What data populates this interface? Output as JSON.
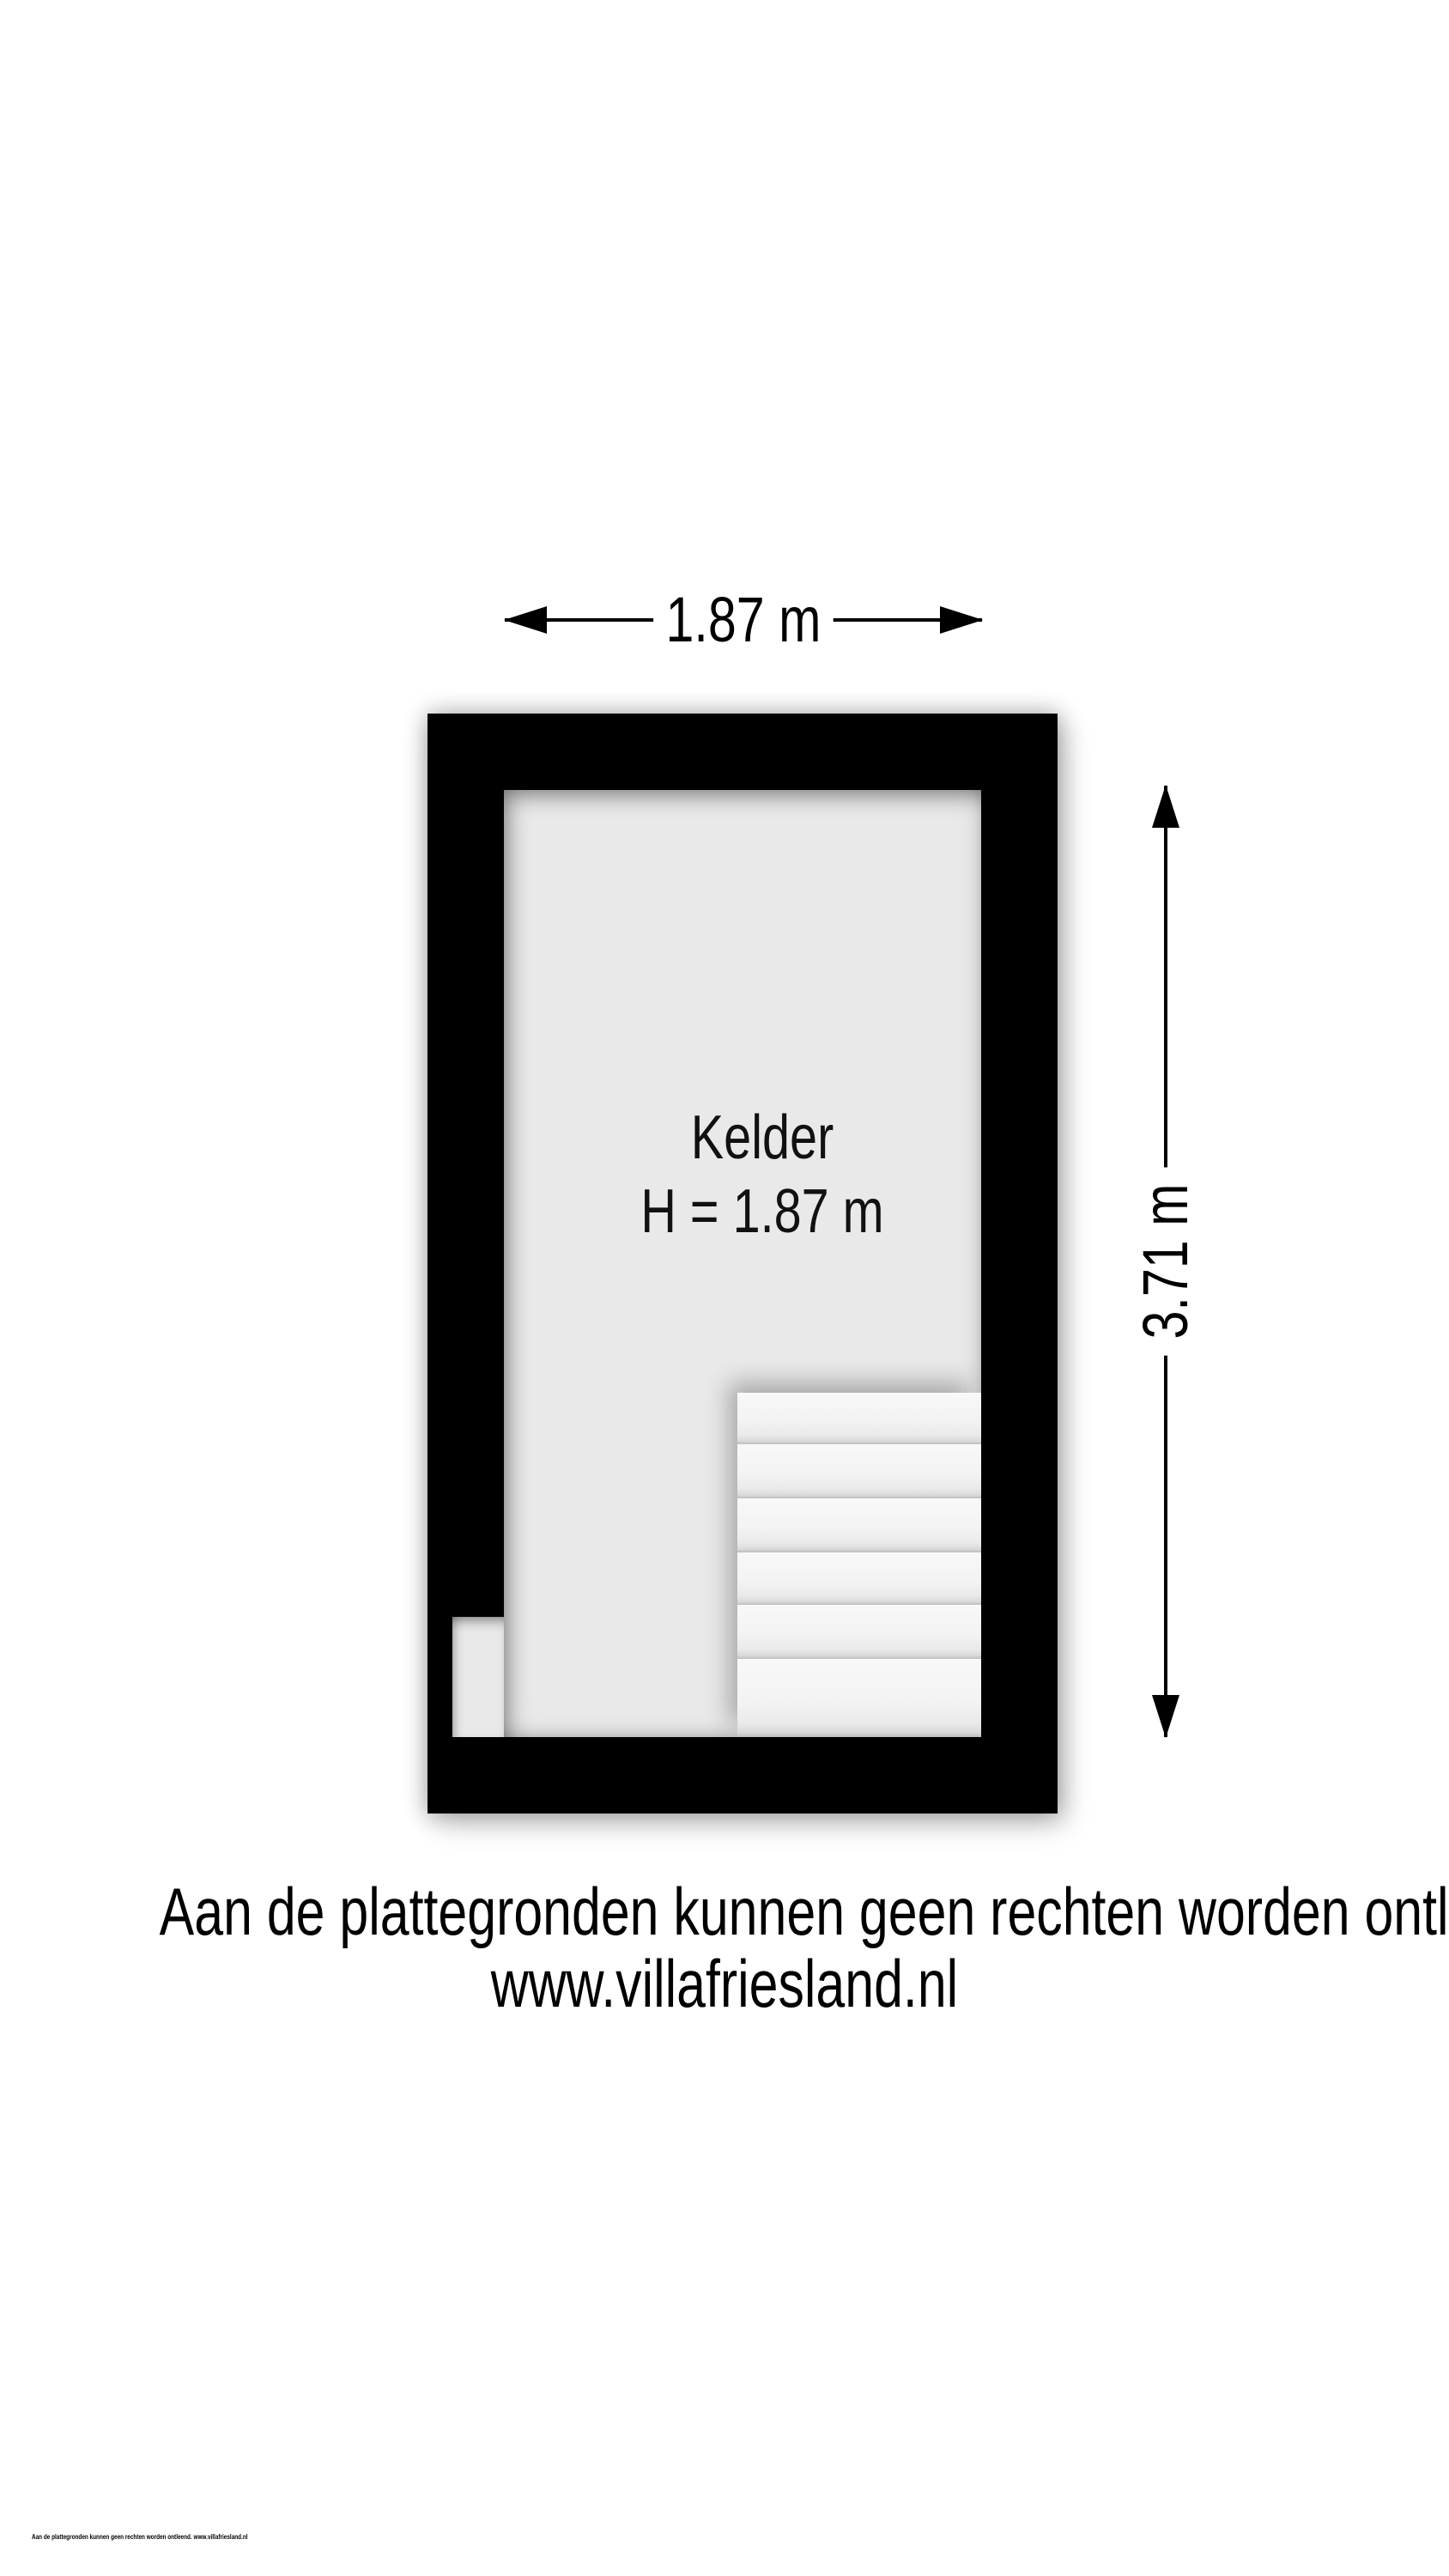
{
  "plan": {
    "room_label": "Kelder",
    "room_height_label": "H = 1.87 m",
    "width_dimension": "1.87 m",
    "depth_dimension": "3.71 m",
    "stairs_steps_count": "6"
  },
  "footer": {
    "disclaimer_line1": "Aan de plattegronden kunnen geen rechten worden ontleend",
    "disclaimer_line2": "www.villafriesland.nl",
    "fineprint": "Aan de plattegronden kunnen geen rechten worden ontleend. www.villafriesland.nl"
  },
  "colors": {
    "wall": "#000000",
    "floor": "#e9e9e9",
    "stair_tread": "#f4f4f4",
    "page_background": "#ffffff",
    "text": "#000000"
  }
}
